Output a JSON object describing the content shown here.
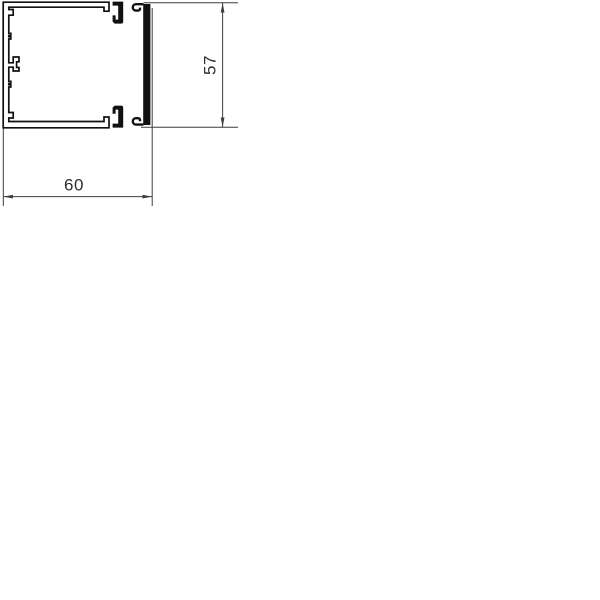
{
  "drawing": {
    "kind": "cable-trunking-cross-section",
    "dimensions": {
      "width_label": "60",
      "height_label": "57"
    },
    "colors": {
      "profile-line": "#111111",
      "dimension-line": "#3d3d3d",
      "dimension-text": "#2e2e2e",
      "background": "#ffffff"
    }
  }
}
